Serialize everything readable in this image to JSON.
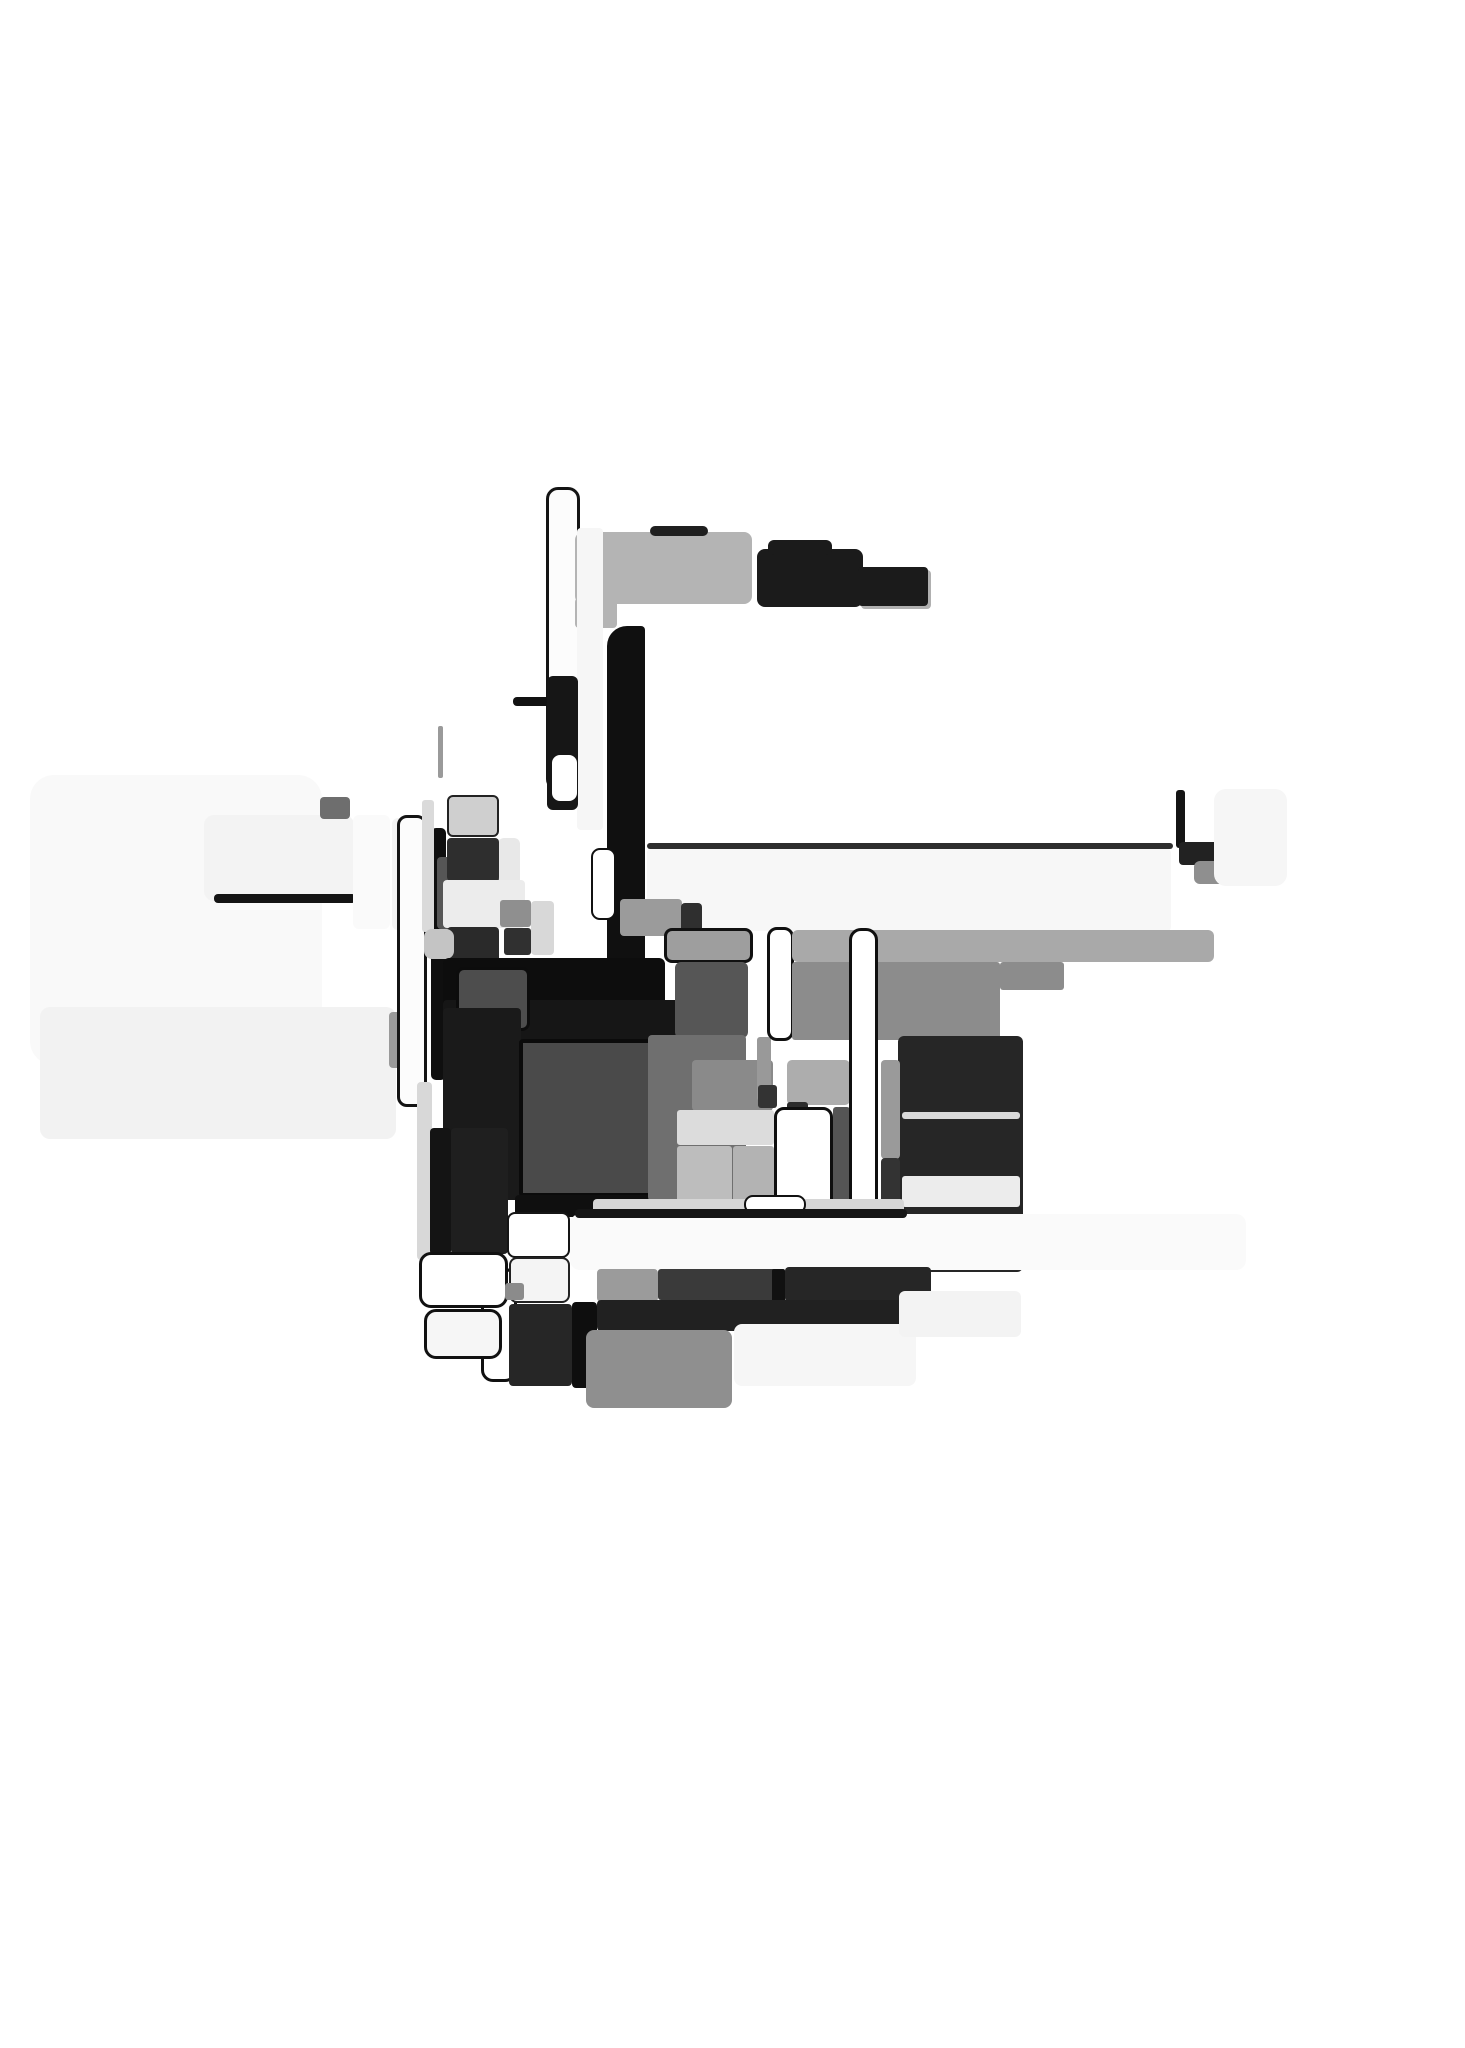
{
  "artwork": {
    "title_hint": "abstract-grayscale-block-collage",
    "background": "#ffffff",
    "width": 1465,
    "height": 2048,
    "palette": {
      "near_black": "#0f0f0f",
      "dark_gray": "#262626",
      "mid_gray": "#4a4a4a",
      "gray": "#8c8c8c",
      "light_gray": "#b4b4b4",
      "pale": "#f2f2f2",
      "white": "#ffffff"
    },
    "shapes": [
      {
        "name": "left-pale-field",
        "x": 30,
        "y": 775,
        "w": 292,
        "h": 290,
        "fill": "#f9f9f9",
        "r": 24
      },
      {
        "name": "left-pale-band",
        "x": 40,
        "y": 1007,
        "w": 356,
        "h": 132,
        "fill": "#f2f2f2",
        "r": 10
      },
      {
        "name": "right-pale-field",
        "x": 647,
        "y": 849,
        "w": 524,
        "h": 82,
        "fill": "#f7f7f7",
        "r": 4
      },
      {
        "name": "right-thin-line",
        "x": 647,
        "y": 843,
        "w": 526,
        "h": 6,
        "fill": "#2e2e2e",
        "r": 3
      },
      {
        "name": "pale-card",
        "x": 204,
        "y": 815,
        "w": 150,
        "h": 86,
        "fill": "#f3f3f3",
        "r": 10
      },
      {
        "name": "pale-card-edge",
        "x": 214,
        "y": 894,
        "w": 142,
        "h": 9,
        "fill": "#141414",
        "r": 4
      },
      {
        "name": "small-dark-chip",
        "x": 320,
        "y": 797,
        "w": 30,
        "h": 22,
        "fill": "#6e6e6e",
        "r": 4
      },
      {
        "name": "pale-column-a",
        "x": 353,
        "y": 815,
        "w": 37,
        "h": 114,
        "fill": "#fafafa",
        "r": 6
      },
      {
        "name": "pale-column-b",
        "x": 392,
        "y": 818,
        "w": 27,
        "h": 112,
        "fill": "#f4f4f4",
        "r": 6
      },
      {
        "name": "gray-elbow",
        "x": 389,
        "y": 1012,
        "w": 21,
        "h": 56,
        "fill": "#9a9a9a",
        "r": 4
      },
      {
        "name": "white-column-outlined",
        "x": 397,
        "y": 815,
        "w": 30,
        "h": 292,
        "fill": "#fcfcfc",
        "r": 10,
        "border": "3px #141414"
      },
      {
        "name": "black-bar-left",
        "x": 431,
        "y": 828,
        "w": 15,
        "h": 252,
        "fill": "#0f0f0f",
        "r": 5
      },
      {
        "name": "pale-sliver",
        "x": 417,
        "y": 1082,
        "w": 15,
        "h": 178,
        "fill": "#d8d8d8",
        "r": 4
      },
      {
        "name": "pale-sliver-2",
        "x": 422,
        "y": 800,
        "w": 12,
        "h": 132,
        "fill": "#dadada",
        "r": 3
      },
      {
        "name": "faint-line",
        "x": 438,
        "y": 726,
        "w": 5,
        "h": 52,
        "fill": "#9a9a9a",
        "r": 2
      },
      {
        "name": "tall-white-rect-outlined",
        "x": 546,
        "y": 487,
        "w": 34,
        "h": 304,
        "fill": "#fcfcfc",
        "r": 12,
        "border": "3px #141414"
      },
      {
        "name": "dark-tick",
        "x": 596,
        "y": 540,
        "w": 6,
        "h": 62,
        "fill": "#3f3f3f",
        "r": 3
      },
      {
        "name": "top-gray-bar",
        "x": 575,
        "y": 532,
        "w": 177,
        "h": 72,
        "fill": "#b4b4b4",
        "r": 8
      },
      {
        "name": "top-gray-bar-foot",
        "x": 575,
        "y": 598,
        "w": 42,
        "h": 30,
        "fill": "#b4b4b4",
        "r": 4
      },
      {
        "name": "top-dark-edge",
        "x": 650,
        "y": 526,
        "w": 58,
        "h": 10,
        "fill": "#1f1f1f",
        "r": 5
      },
      {
        "name": "black-step-main",
        "x": 757,
        "y": 549,
        "w": 106,
        "h": 58,
        "fill": "#1b1b1b",
        "r": 8
      },
      {
        "name": "black-step-bump",
        "x": 768,
        "y": 540,
        "w": 64,
        "h": 15,
        "fill": "#1b1b1b",
        "r": 6
      },
      {
        "name": "black-step-right",
        "x": 858,
        "y": 567,
        "w": 70,
        "h": 39,
        "fill": "#1b1b1b",
        "r": 4,
        "shadow": "3px 3px 0 #b0b0b0"
      },
      {
        "name": "pale-strip-mid",
        "x": 577,
        "y": 528,
        "w": 26,
        "h": 302,
        "fill": "#f6f6f6",
        "r": 4
      },
      {
        "name": "hook-line",
        "x": 513,
        "y": 697,
        "w": 52,
        "h": 9,
        "fill": "#121212",
        "r": 4
      },
      {
        "name": "hook-drop",
        "x": 551,
        "y": 700,
        "w": 13,
        "h": 42,
        "fill": "#121212",
        "r": 4
      },
      {
        "name": "black-column-mid",
        "x": 547,
        "y": 676,
        "w": 31,
        "h": 134,
        "fill": "#161616",
        "r": 6
      },
      {
        "name": "white-notch",
        "x": 552,
        "y": 755,
        "w": 25,
        "h": 46,
        "fill": "#ffffff",
        "r": 8
      },
      {
        "name": "thick-black-border-bar",
        "x": 607,
        "y": 626,
        "w": 38,
        "h": 370,
        "fill": "#101010",
        "r": "20px 4px 4px 12px"
      },
      {
        "name": "pale-chip",
        "x": 498,
        "y": 838,
        "w": 22,
        "h": 62,
        "fill": "#e8e8e8",
        "r": 6
      },
      {
        "name": "gray-block-a",
        "x": 437,
        "y": 857,
        "w": 62,
        "h": 72,
        "fill": "#565656",
        "r": 4
      },
      {
        "name": "light-block",
        "x": 447,
        "y": 795,
        "w": 52,
        "h": 42,
        "fill": "#cfcfcf",
        "r": 6,
        "border": "2px #222222"
      },
      {
        "name": "dark-block-a",
        "x": 447,
        "y": 838,
        "w": 52,
        "h": 43,
        "fill": "#2e2e2e",
        "r": 4
      },
      {
        "name": "pale-row",
        "x": 443,
        "y": 880,
        "w": 82,
        "h": 48,
        "fill": "#ececec",
        "r": 4
      },
      {
        "name": "dark-block-b",
        "x": 447,
        "y": 927,
        "w": 52,
        "h": 50,
        "fill": "#2a2a2a",
        "r": 4
      },
      {
        "name": "gray-wedge",
        "x": 424,
        "y": 929,
        "w": 30,
        "h": 30,
        "fill": "#c4c4c4",
        "r": 8
      },
      {
        "name": "gray-chip-a",
        "x": 500,
        "y": 900,
        "w": 31,
        "h": 27,
        "fill": "#8f8f8f",
        "r": 3
      },
      {
        "name": "dark-chip-a",
        "x": 504,
        "y": 928,
        "w": 27,
        "h": 27,
        "fill": "#303030",
        "r": 3
      },
      {
        "name": "light-chip",
        "x": 531,
        "y": 901,
        "w": 23,
        "h": 54,
        "fill": "#d8d8d8",
        "r": 4
      },
      {
        "name": "gray-block-b",
        "x": 620,
        "y": 899,
        "w": 62,
        "h": 37,
        "fill": "#9b9b9b",
        "r": 4
      },
      {
        "name": "dark-chip-b",
        "x": 681,
        "y": 903,
        "w": 21,
        "h": 29,
        "fill": "#2f2f2f",
        "r": 4
      },
      {
        "name": "small-white-pill",
        "x": 591,
        "y": 848,
        "w": 25,
        "h": 72,
        "fill": "#ffffff",
        "r": 9,
        "border": "2px #111111"
      },
      {
        "name": "black-slab",
        "x": 443,
        "y": 958,
        "w": 222,
        "h": 50,
        "fill": "#0d0d0d",
        "r": 6
      },
      {
        "name": "dark-filler",
        "x": 443,
        "y": 1000,
        "w": 242,
        "h": 44,
        "fill": "#161616",
        "r": 4
      },
      {
        "name": "mid-dark-block",
        "x": 456,
        "y": 967,
        "w": 74,
        "h": 64,
        "fill": "#4d4d4d",
        "r": 8,
        "border": "3px #0c0c0c"
      },
      {
        "name": "black-left-column",
        "x": 443,
        "y": 1008,
        "w": 78,
        "h": 192,
        "fill": "#1a1a1a",
        "r": 4
      },
      {
        "name": "central-dark-square",
        "x": 519,
        "y": 1039,
        "w": 162,
        "h": 158,
        "fill": "#4a4a4a",
        "r": 4,
        "border": "4px #0b0b0b"
      },
      {
        "name": "square-underline",
        "x": 515,
        "y": 1195,
        "w": 170,
        "h": 22,
        "fill": "#0f0f0f",
        "r": 4
      },
      {
        "name": "gray-cap",
        "x": 664,
        "y": 928,
        "w": 89,
        "h": 35,
        "fill": "#9e9e9e",
        "r": 8,
        "border": "3px #111111"
      },
      {
        "name": "gray-cap-inner",
        "x": 675,
        "y": 962,
        "w": 73,
        "h": 76,
        "fill": "#565656",
        "r": 6
      },
      {
        "name": "gray-column",
        "x": 648,
        "y": 1035,
        "w": 98,
        "h": 166,
        "fill": "#6f6f6f",
        "r": 4
      },
      {
        "name": "gray-block-c",
        "x": 692,
        "y": 1060,
        "w": 81,
        "h": 51,
        "fill": "#8a8a8a",
        "r": 4
      },
      {
        "name": "light-band",
        "x": 677,
        "y": 1110,
        "w": 97,
        "h": 35,
        "fill": "#dcdcdc",
        "r": 3
      },
      {
        "name": "gray-panel-a",
        "x": 677,
        "y": 1146,
        "w": 55,
        "h": 58,
        "fill": "#bdbdbd",
        "r": 3
      },
      {
        "name": "gray-panel-b",
        "x": 733,
        "y": 1146,
        "w": 41,
        "h": 58,
        "fill": "#b3b3b3",
        "r": 3
      },
      {
        "name": "gray-sliver",
        "x": 757,
        "y": 1037,
        "w": 14,
        "h": 64,
        "fill": "#999999",
        "r": 3
      },
      {
        "name": "dark-chip-c",
        "x": 758,
        "y": 1085,
        "w": 19,
        "h": 23,
        "fill": "#333333",
        "r": 3
      },
      {
        "name": "gray-block-d",
        "x": 787,
        "y": 1060,
        "w": 63,
        "h": 45,
        "fill": "#adadad",
        "r": 5
      },
      {
        "name": "dark-chip-d",
        "x": 787,
        "y": 1102,
        "w": 21,
        "h": 17,
        "fill": "#2c2c2c",
        "r": 3
      },
      {
        "name": "white-pill-a",
        "x": 767,
        "y": 927,
        "w": 27,
        "h": 114,
        "fill": "#ffffff",
        "r": 10,
        "border": "3px #101010"
      },
      {
        "name": "wide-gray-bar",
        "x": 792,
        "y": 930,
        "w": 422,
        "h": 32,
        "fill": "#a9a9a9",
        "r": 6
      },
      {
        "name": "gray-slab",
        "x": 792,
        "y": 962,
        "w": 208,
        "h": 78,
        "fill": "#8c8c8c",
        "r": 3
      },
      {
        "name": "gray-slab-step",
        "x": 1000,
        "y": 962,
        "w": 64,
        "h": 28,
        "fill": "#8c8c8c",
        "r": 3
      },
      {
        "name": "hook-vertical",
        "x": 1176,
        "y": 790,
        "w": 9,
        "h": 58,
        "fill": "#141414",
        "r": 3
      },
      {
        "name": "hook-block",
        "x": 1179,
        "y": 842,
        "w": 42,
        "h": 23,
        "fill": "#222222",
        "r": 4
      },
      {
        "name": "gray-wedge-2",
        "x": 1194,
        "y": 861,
        "w": 62,
        "h": 23,
        "fill": "#8f8f8f",
        "r": 6
      },
      {
        "name": "pale-square",
        "x": 1214,
        "y": 789,
        "w": 73,
        "h": 97,
        "fill": "#f6f6f6",
        "r": 12
      },
      {
        "name": "right-dark-column",
        "x": 898,
        "y": 1036,
        "w": 125,
        "h": 236,
        "fill": "#262626",
        "r": 6
      },
      {
        "name": "dark-col-light-line",
        "x": 902,
        "y": 1112,
        "w": 118,
        "h": 7,
        "fill": "#d9d9d9",
        "r": 3
      },
      {
        "name": "dark-col-light-band",
        "x": 902,
        "y": 1176,
        "w": 118,
        "h": 31,
        "fill": "#ececec",
        "r": 3
      },
      {
        "name": "white-column-b",
        "x": 774,
        "y": 1107,
        "w": 59,
        "h": 105,
        "fill": "#ffffff",
        "r": 10,
        "border": "3px #0f0f0f"
      },
      {
        "name": "dark-strip",
        "x": 833,
        "y": 1107,
        "w": 17,
        "h": 105,
        "fill": "#555555",
        "r": 3
      },
      {
        "name": "tall-white-pill",
        "x": 849,
        "y": 928,
        "w": 29,
        "h": 345,
        "fill": "#ffffff",
        "r": 12,
        "border": "3px #0f0f0f"
      },
      {
        "name": "gray-bar-vertical",
        "x": 881,
        "y": 1060,
        "w": 19,
        "h": 99,
        "fill": "#9a9a9a",
        "r": 4
      },
      {
        "name": "dark-bar-vertical",
        "x": 881,
        "y": 1158,
        "w": 19,
        "h": 96,
        "fill": "#333333",
        "r": 4
      },
      {
        "name": "black-bar-lower",
        "x": 430,
        "y": 1128,
        "w": 21,
        "h": 127,
        "fill": "#141414",
        "r": 4
      },
      {
        "name": "dark-block-lower",
        "x": 451,
        "y": 1128,
        "w": 57,
        "h": 126,
        "fill": "#1f1f1f",
        "r": 4
      },
      {
        "name": "light-bar",
        "x": 593,
        "y": 1199,
        "w": 311,
        "h": 15,
        "fill": "#d6d6d6",
        "r": 4
      },
      {
        "name": "white-pill-b",
        "x": 744,
        "y": 1195,
        "w": 62,
        "h": 19,
        "fill": "#ffffff",
        "r": 9,
        "border": "2px #111111"
      },
      {
        "name": "big-white-slab",
        "x": 570,
        "y": 1214,
        "w": 676,
        "h": 56,
        "fill": "#fafafa",
        "r": 10
      },
      {
        "name": "slab-dark-edge",
        "x": 575,
        "y": 1209,
        "w": 332,
        "h": 9,
        "fill": "#151515",
        "r": 4
      },
      {
        "name": "gray-chip-b",
        "x": 597,
        "y": 1269,
        "w": 61,
        "h": 33,
        "fill": "#9b9b9b",
        "r": 4
      },
      {
        "name": "dark-row-a",
        "x": 658,
        "y": 1269,
        "w": 126,
        "h": 31,
        "fill": "#3a3a3a",
        "r": 3
      },
      {
        "name": "black-strip",
        "x": 772,
        "y": 1269,
        "w": 13,
        "h": 33,
        "fill": "#111111",
        "r": 2
      },
      {
        "name": "dark-row-b",
        "x": 785,
        "y": 1267,
        "w": 146,
        "h": 35,
        "fill": "#262626",
        "r": 4
      },
      {
        "name": "dark-band",
        "x": 597,
        "y": 1300,
        "w": 334,
        "h": 31,
        "fill": "#212121",
        "r": 4
      },
      {
        "name": "white-pill-c",
        "x": 481,
        "y": 1268,
        "w": 36,
        "h": 114,
        "fill": "#ffffff",
        "r": 12,
        "border": "3px #101010"
      },
      {
        "name": "white-slab-b",
        "x": 507,
        "y": 1212,
        "w": 63,
        "h": 46,
        "fill": "#ffffff",
        "r": 8,
        "border": "2px #151515"
      },
      {
        "name": "pale-slab",
        "x": 509,
        "y": 1257,
        "w": 61,
        "h": 46,
        "fill": "#f4f4f4",
        "r": 8,
        "border": "2px #222222"
      },
      {
        "name": "dark-tall-block",
        "x": 509,
        "y": 1304,
        "w": 63,
        "h": 82,
        "fill": "#262626",
        "r": 4
      },
      {
        "name": "black-bar-bottom",
        "x": 572,
        "y": 1302,
        "w": 25,
        "h": 86,
        "fill": "#0e0e0e",
        "r": 4
      },
      {
        "name": "white-pill-d",
        "x": 419,
        "y": 1252,
        "w": 89,
        "h": 56,
        "fill": "#ffffff",
        "r": 12,
        "border": "3px #111111"
      },
      {
        "name": "white-pill-e",
        "x": 424,
        "y": 1309,
        "w": 78,
        "h": 50,
        "fill": "#f6f6f6",
        "r": 12,
        "border": "3px #111111"
      },
      {
        "name": "gray-chip-c",
        "x": 505,
        "y": 1283,
        "w": 19,
        "h": 17,
        "fill": "#8b8b8b",
        "r": 3
      },
      {
        "name": "bottom-gray-tongue",
        "x": 586,
        "y": 1330,
        "w": 146,
        "h": 78,
        "fill": "#8f8f8f",
        "r": 8
      },
      {
        "name": "bottom-white-slab",
        "x": 734,
        "y": 1324,
        "w": 182,
        "h": 62,
        "fill": "#f6f6f6",
        "r": 8
      },
      {
        "name": "bottom-pale-slab",
        "x": 899,
        "y": 1291,
        "w": 122,
        "h": 46,
        "fill": "#f3f3f3",
        "r": 6
      }
    ]
  }
}
